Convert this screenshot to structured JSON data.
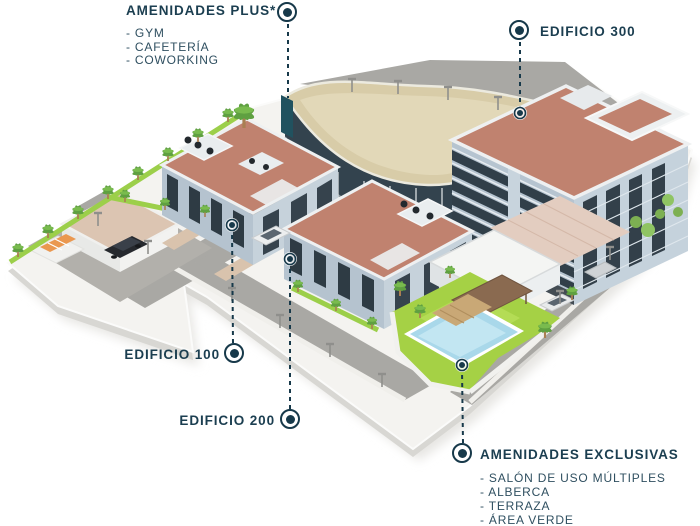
{
  "callouts": {
    "amenidades_plus": {
      "title": "AMENIDADES PLUS*",
      "items": [
        "- GYM",
        "- CAFETERÍA",
        "- COWORKING"
      ]
    },
    "edificio_300": {
      "title": "EDIFICIO 300"
    },
    "edificio_100": {
      "title": "EDIFICIO 100"
    },
    "edificio_200": {
      "title": "EDIFICIO 200"
    },
    "amenidades_exclusivas": {
      "title": "AMENIDADES EXCLUSIVAS",
      "items": [
        "- SALÓN DE USO MÚLTIPLES",
        "- ALBERCA",
        "- TERRAZA",
        "- ÁREA VERDE"
      ]
    }
  },
  "colors": {
    "accent": "#17394a",
    "roof_terracotta": "#c0826f",
    "building_wall": "#b5c3cf",
    "window_dark": "#2e3b44",
    "lawn_green": "#9ccf4a",
    "pool_blue": "#a9d8ea",
    "road_gray": "#a9a8a4",
    "paver_tan": "#d9c3ad",
    "site_plate": "#f4f3f0"
  },
  "icons": {
    "marker": "map-pin-dot",
    "anchor": "anchor-dot",
    "palm": "palm-tree",
    "lamp": "street-lamp"
  }
}
